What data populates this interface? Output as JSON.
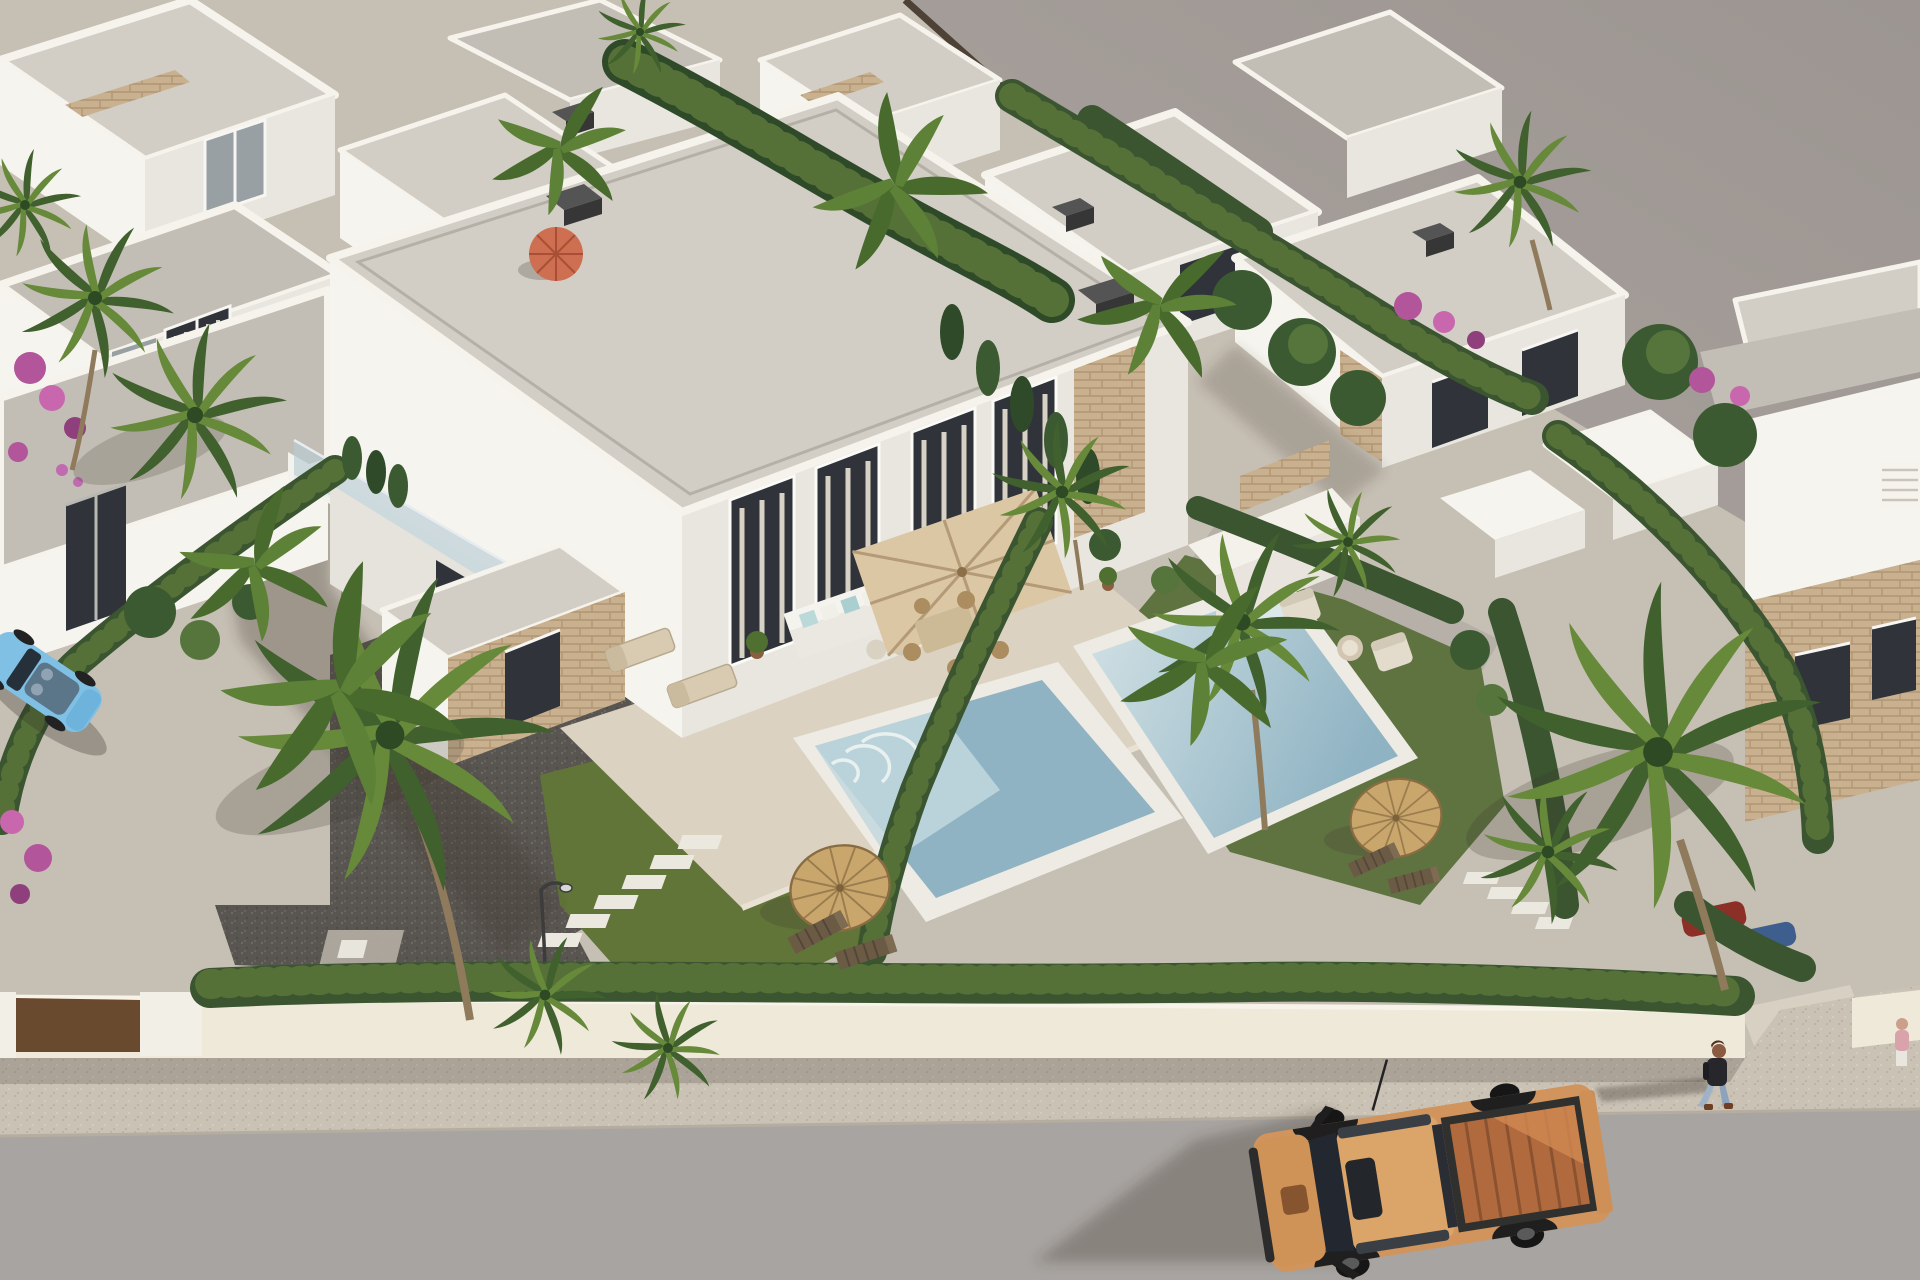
{
  "scene": {
    "type": "architectural-3d-render",
    "view": "aerial oblique aerial view of a new-build villa development",
    "description": "White flat-roofed modern villas with travertine stone accents, private pools, lawns, cypress hedges, palm trees, gravel drives, a white perimeter wall with corten gate, and a street with a parked pickup truck and a pedestrian.",
    "lighting": "warm afternoon sun from the upper right casting long soft shadows to the lower left"
  },
  "palette": {
    "pavement": "#c6bfb4",
    "open_ground": "#a69f9a",
    "road": "#a8a4a1",
    "sidewalk": "#cbc3b6",
    "wall_white": "#efe9da",
    "gate_brown": "#6a4a2e",
    "hedge_dark": "#3a5530",
    "hedge_light": "#567138",
    "grass": "#617539",
    "gravel": "#595551",
    "roof_light": "#d2cec5",
    "villa_white": "#f6f4ee",
    "villa_shade": "#e9e6df",
    "stone": "#c9b190",
    "window_dark": "#30343a",
    "curtain": "#d8d2c6",
    "terrace": "#dcd2c2",
    "pool_shallow": "#d3e2e5",
    "pool_deep": "#8fb3c3",
    "coping": "#edebe3",
    "parasol_beige": "#dbc7a4",
    "thatch": "#c9a66b",
    "palm_dark": "#40602e",
    "palm_light": "#67893a",
    "umbrella_orange": "#cd6f50",
    "truck_body": "#d0945c",
    "truck_bed": "#b06a3e",
    "car_blue": "#7fc0e4",
    "flower_magenta": "#b2559b",
    "shadow": "rgba(62,56,50,0.30)"
  },
  "objects": {
    "villas": {
      "count_visible": 12,
      "style": "two-storey white cubes with parapet flat roofs and stone-clad accent columns"
    },
    "pools": {
      "count": 4,
      "note": "two foreground garden pools with mosaic water, one small rear plunge pool, plus neighbouring pool corner"
    },
    "vehicles": [
      {
        "name": "pickup-truck",
        "color": "orange-tan, open bed",
        "location": "street, bottom centre-right"
      },
      {
        "name": "convertible-car",
        "color": "light blue",
        "location": "left kerb, partially cropped"
      },
      {
        "name": "hidden-cars",
        "color": "red and dark blue",
        "location": "behind right hedge"
      }
    ],
    "people": [
      {
        "name": "pedestrian",
        "detail": "dark jacket, light jeans, walking on sidewalk near the truck"
      },
      {
        "name": "pedestrian-partial",
        "detail": "far right edge, mostly cropped"
      }
    ],
    "landscape": [
      "fan palms",
      "banana plants",
      "cypress hedges",
      "round shrubs",
      "magenta bougainvillea",
      "lawns",
      "gravel drives",
      "stepping stones"
    ],
    "furniture": [
      "beige terrace parasol with dining set",
      "white L-shaped lounge sofa",
      "beige sun loungers",
      "two thatched palapa umbrellas",
      "wooden deck chairs",
      "street lamp",
      "orange garden umbrella"
    ]
  }
}
